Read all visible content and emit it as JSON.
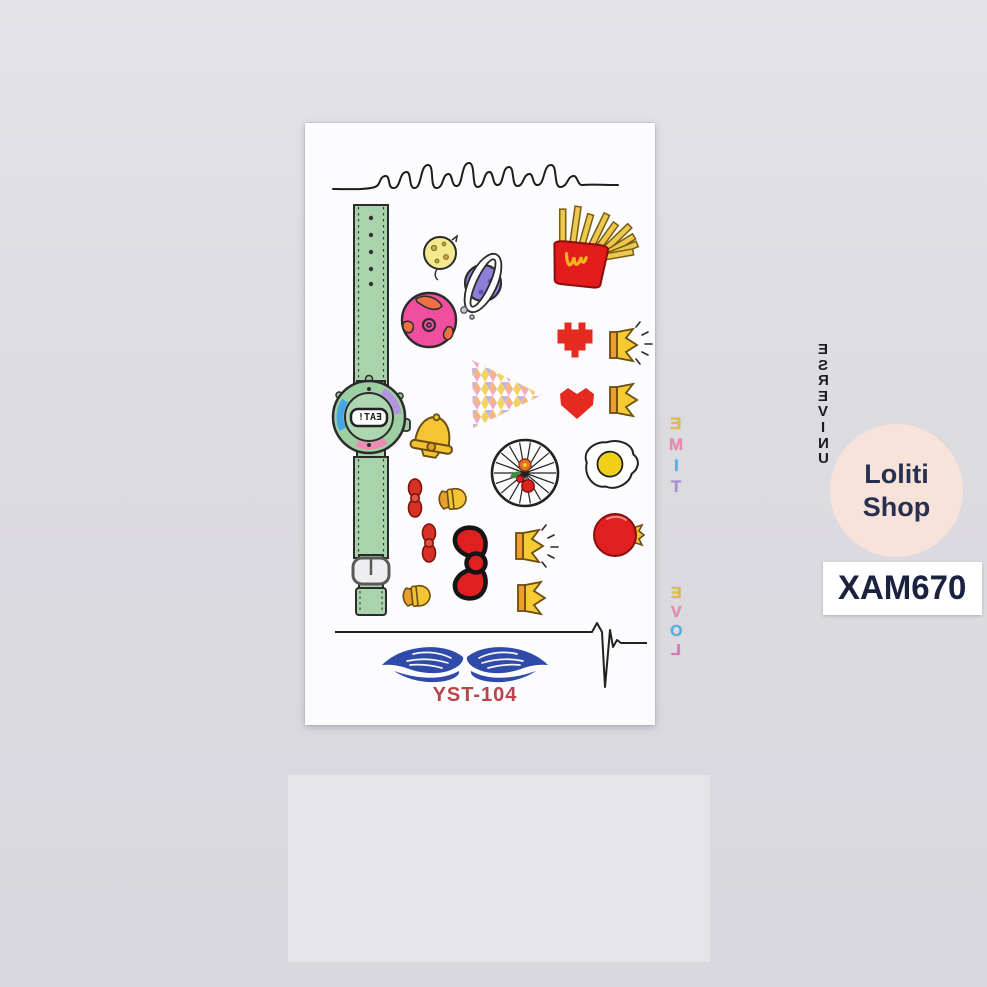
{
  "photo": {
    "background_color": "#dcdbe0",
    "table_strip_color": "#e5e4e9",
    "card_color": "#fcfbfd"
  },
  "tattoo_sheet": {
    "sheet_code": "YST-104",
    "sheet_code_color": "#b8434a",
    "mirrored_texts": {
      "universe": "UNIVERSE",
      "watch_strap_top": "TIME",
      "watch_strap_bottom": "LOVE",
      "watch_display": "EAT!"
    },
    "icons": [
      "mirrored-cursive-script-line",
      "green-digital-wristwatch",
      "yellow-moon-with-craters",
      "purple-ringed-planet",
      "pink-planet-with-donut",
      "french-fries-red-box",
      "red-pixel-heart",
      "yellow-crown-with-sparkles",
      "red-angular-heart",
      "yellow-crown",
      "pastel-mosaic-triangle",
      "yellow-bell",
      "spoke-wheel-with-cherries",
      "fried-egg",
      "red-mini-bow",
      "yellow-mini-bow",
      "red-hello-kitty-bow",
      "yellow-crown-with-sparkles-2",
      "pomegranate-with-crown",
      "red-mini-bow-2",
      "yellow-mini-bow-2",
      "yellow-crown-2",
      "heartbeat-ekg-line",
      "blue-tribal-wings"
    ],
    "palette": {
      "red": "#e52b20",
      "yellow": "#f3c433",
      "orange": "#ee9d2e",
      "green_strap": "#a9d3ab",
      "blue_wings": "#2f4aa8",
      "pink_planet": "#ef4f9e",
      "purple_planet": "#8d7ed8"
    }
  },
  "shop_badge": {
    "line1": "Loliti",
    "line2": "Shop",
    "bg_color": "#f8e3da",
    "text_color": "#28304f"
  },
  "sku_tag": {
    "code": "XAM670",
    "bg_color": "#ffffff",
    "text_color": "#1b2240"
  }
}
